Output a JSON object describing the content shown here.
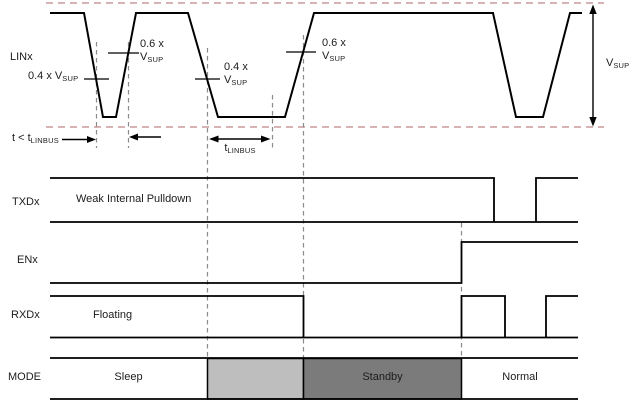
{
  "colors": {
    "threshold_dash": "#cb9a9a",
    "guide_dash": "#8a8a8a",
    "signal_stroke": "#000000",
    "mode_transition_fill": "#bebebe",
    "mode_standby_fill": "#7b7b7b"
  },
  "signals": {
    "lin": {
      "label": "LINx"
    },
    "txd": {
      "label": "TXDx",
      "state": "Weak Internal Pulldown"
    },
    "en": {
      "label": "ENx"
    },
    "rxd": {
      "label": "RXDx",
      "state": "Floating"
    },
    "mode": {
      "label": "MODE",
      "states": {
        "sleep": "Sleep",
        "standby": "Standby",
        "normal": "Normal"
      }
    }
  },
  "annotations": {
    "th_04_first": {
      "text": "0.4 x V",
      "sub": "SUP"
    },
    "th_06_first": {
      "line1": "0.6 x",
      "base": "V",
      "sub": "SUP"
    },
    "th_04_second": {
      "line1": "0.4 x",
      "base": "V",
      "sub": "SUP"
    },
    "th_06_second": {
      "line1": "0.6 x",
      "base": "V",
      "sub": "SUP"
    },
    "t_short": {
      "text": "t < t",
      "sub": "LINBUS"
    },
    "t_linbus": {
      "text": "t",
      "sub": "LINBUS"
    },
    "v_sup": {
      "text": "V",
      "sub": "SUP"
    }
  }
}
